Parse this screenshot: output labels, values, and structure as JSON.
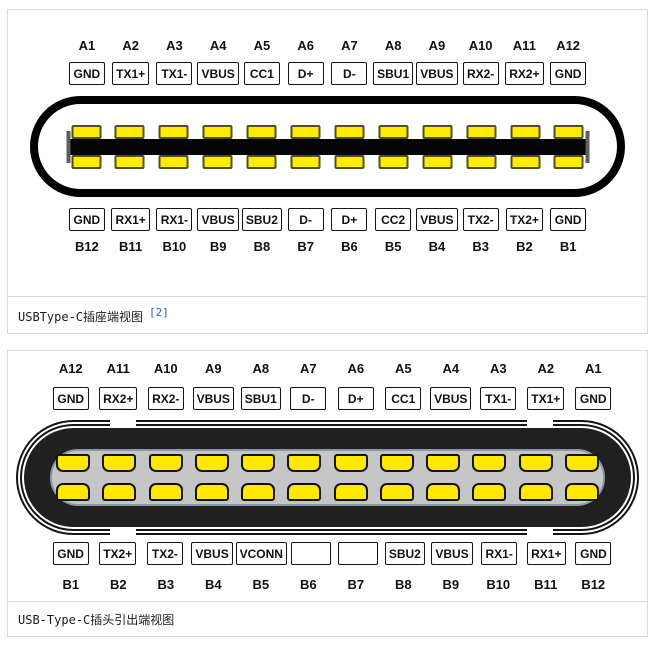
{
  "colors": {
    "card_border": "#d9d9d9",
    "pad_yellow": "#ffec00",
    "receptacle_outline": "#000000",
    "plug_body": "#202020",
    "cavity_gray": "#c6c6c6",
    "citation_blue": "#2f58c9"
  },
  "figure1": {
    "caption": "USBType-C插座端视图",
    "citation": "[2]",
    "top_nums": [
      "A1",
      "A2",
      "A3",
      "A4",
      "A5",
      "A6",
      "A7",
      "A8",
      "A9",
      "A10",
      "A11",
      "A12"
    ],
    "top_labels": [
      "GND",
      "TX1+",
      "TX1-",
      "VBUS",
      "CC1",
      "D+",
      "D-",
      "SBU1",
      "VBUS",
      "RX2-",
      "RX2+",
      "GND"
    ],
    "bottom_labels": [
      "GND",
      "RX1+",
      "RX1-",
      "VBUS",
      "SBU2",
      "D-",
      "D+",
      "CC2",
      "VBUS",
      "TX2-",
      "TX2+",
      "GND"
    ],
    "bottom_nums": [
      "B12",
      "B11",
      "B10",
      "B9",
      "B8",
      "B7",
      "B6",
      "B5",
      "B4",
      "B3",
      "B2",
      "B1"
    ]
  },
  "figure2": {
    "caption": "USB-Type-C插头引出端视图",
    "top_nums": [
      "A12",
      "A11",
      "A10",
      "A9",
      "A8",
      "A7",
      "A6",
      "A5",
      "A4",
      "A3",
      "A2",
      "A1"
    ],
    "top_labels": [
      "GND",
      "RX2+",
      "RX2-",
      "VBUS",
      "SBU1",
      "D-",
      "D+",
      "CC1",
      "VBUS",
      "TX1-",
      "TX1+",
      "GND"
    ],
    "bottom_labels": [
      "GND",
      "TX2+",
      "TX2-",
      "VBUS",
      "VCONN",
      "",
      "",
      "SBU2",
      "VBUS",
      "RX1-",
      "RX1+",
      "GND"
    ],
    "bottom_nums": [
      "B1",
      "B2",
      "B3",
      "B4",
      "B5",
      "B6",
      "B7",
      "B8",
      "B9",
      "B10",
      "B11",
      "B12"
    ]
  }
}
